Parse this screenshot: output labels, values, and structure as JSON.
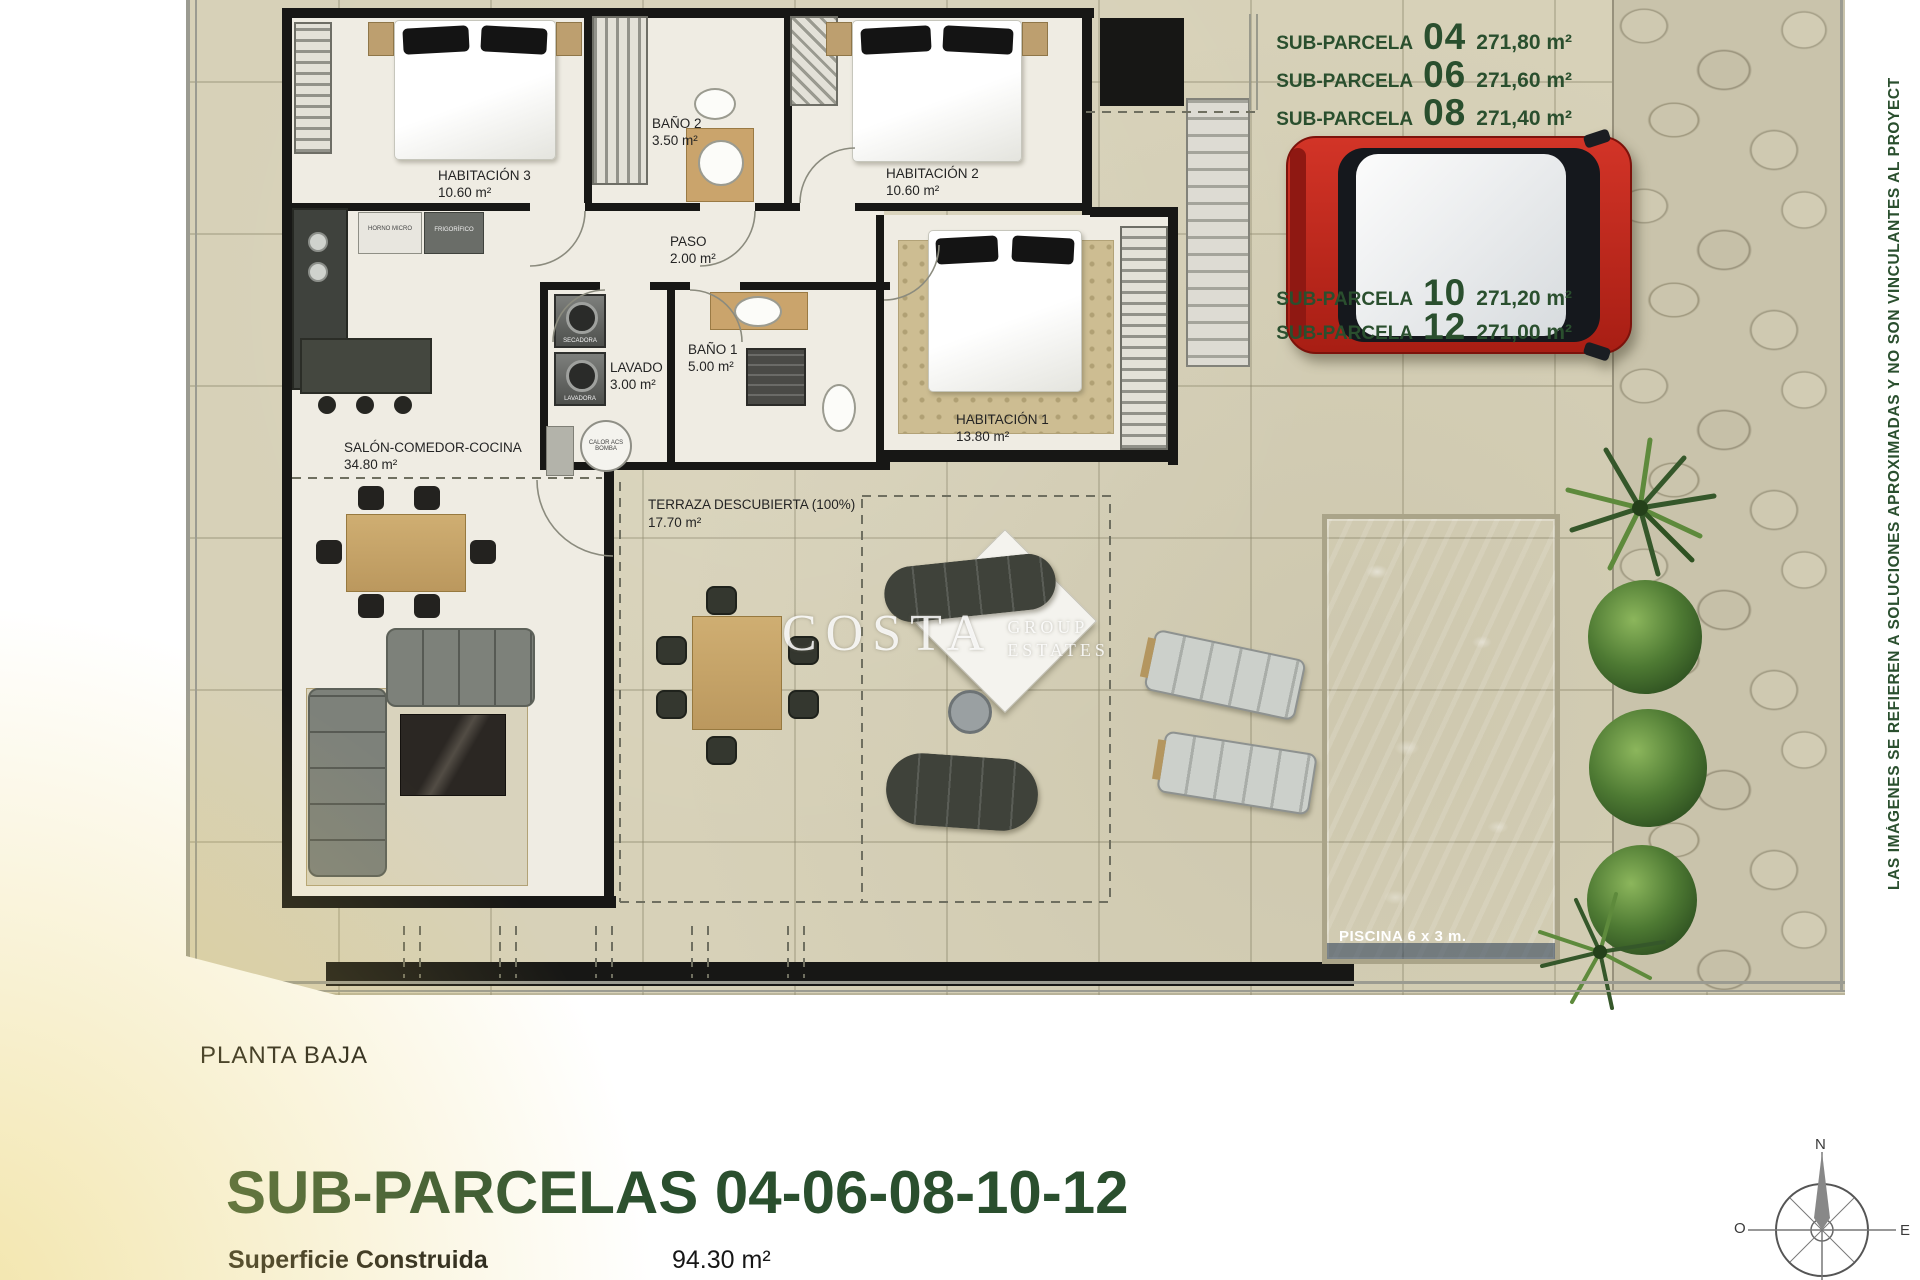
{
  "plan": {
    "subparcelas": [
      {
        "name": "SUB-PARCELA",
        "num": "04",
        "area": "271,80 m²"
      },
      {
        "name": "SUB-PARCELA",
        "num": "06",
        "area": "271,60 m²"
      },
      {
        "name": "SUB-PARCELA",
        "num": "08",
        "area": "271,40 m²"
      },
      {
        "name": "SUB-PARCELA",
        "num": "10",
        "area": "271,20 m²"
      },
      {
        "name": "SUB-PARCELA",
        "num": "12",
        "area": "271,00 m²"
      }
    ],
    "rooms": {
      "hab3": {
        "name": "HABITACIÓN 3",
        "area": "10.60 m²"
      },
      "hab2": {
        "name": "HABITACIÓN 2",
        "area": "10.60 m²"
      },
      "hab1": {
        "name": "HABITACIÓN 1",
        "area": "13.80 m²"
      },
      "bano2": {
        "name": "BAÑO 2",
        "area": "3.50 m²"
      },
      "bano1": {
        "name": "BAÑO 1",
        "area": "5.00 m²"
      },
      "paso": {
        "name": "PASO",
        "area": "2.00 m²"
      },
      "lavado": {
        "name": "LAVADO",
        "area": "3.00 m²"
      },
      "salon": {
        "name": "SALÓN-COMEDOR-COCINA",
        "area": "34.80 m²"
      },
      "terraza": {
        "name": "TERRAZA DESCUBIERTA (100%)",
        "area": "17.70 m²"
      }
    },
    "appliances": {
      "horno": "HORNO MICRO",
      "frigo": "FRIGORÍFICO",
      "secadora": "SECADORA",
      "lavadora": "LAVADORA",
      "calor": "CALOR ACS BOMBA"
    },
    "pool_label": "PISCINA 6 x 3 m.",
    "watermark": {
      "main": "COSTA",
      "sub1": "GROUP",
      "sub2": "ESTATES"
    },
    "side_note": "LAS IMÁGENES SE REFIEREN A SOLUCIONES APROXIMADAS Y NO SON VINCULANTES AL PROYECT"
  },
  "footer": {
    "floor": "PLANTA BAJA",
    "title": "SUB-PARCELAS 04-06-08-10-12",
    "surface_label": "Superficie Construida",
    "surface_value": "94.30 m²"
  },
  "compass": {
    "n": "N",
    "o": "O",
    "e": "E"
  },
  "colors": {
    "green": "#2a4f2e",
    "pool": "#6591bd",
    "car": "#c0281c"
  }
}
